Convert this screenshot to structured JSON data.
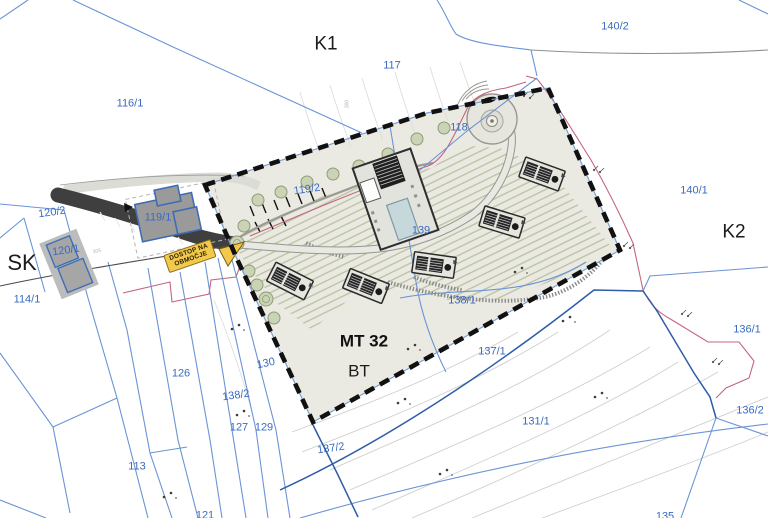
{
  "map": {
    "type": "cadastral-site-plan",
    "colors": {
      "parcel_label": "#3a6bc0",
      "zone_label": "#1c1c1c",
      "site_boundary_dash": "#111111",
      "parcel_line": "#6b94d6",
      "parcel_line_dark": "#2d5da8",
      "development_line_pink": "#c4657f",
      "site_fill": "#ebeae2",
      "road_dark": "#3f3f3f",
      "banner_bg": "#f2c94c",
      "tree_fill": "#cbd3b6",
      "pool_fill": "#c6d8da"
    }
  },
  "banner": {
    "line1": "DOSTOP NA",
    "line2": "OBMOČJE"
  },
  "labels": [
    {
      "text": "K1",
      "x": 326,
      "y": 44,
      "type": "zone",
      "size": 19,
      "rot": 0
    },
    {
      "text": "K2",
      "x": 734,
      "y": 232,
      "type": "zone",
      "size": 19,
      "rot": 0
    },
    {
      "text": "SK",
      "x": 22,
      "y": 263,
      "type": "zone",
      "size": 22,
      "rot": 0
    },
    {
      "text": "MT 32",
      "x": 364,
      "y": 341,
      "type": "zone-bold",
      "size": 17,
      "rot": 0
    },
    {
      "text": "BT",
      "x": 359,
      "y": 371,
      "type": "zone",
      "size": 17,
      "rot": 0
    },
    {
      "text": "116/1",
      "x": 130,
      "y": 104,
      "type": "parcel",
      "size": 11,
      "rot": 0
    },
    {
      "text": "117",
      "x": 392,
      "y": 66,
      "type": "parcel",
      "size": 11,
      "rot": 0
    },
    {
      "text": "140/2",
      "x": 615,
      "y": 27,
      "type": "parcel",
      "size": 11,
      "rot": 0
    },
    {
      "text": "140/1",
      "x": 694,
      "y": 191,
      "type": "parcel",
      "size": 11,
      "rot": 0
    },
    {
      "text": "136/1",
      "x": 747,
      "y": 330,
      "type": "parcel",
      "size": 11,
      "rot": 0
    },
    {
      "text": "136/2",
      "x": 750,
      "y": 411,
      "type": "parcel",
      "size": 11,
      "rot": 0
    },
    {
      "text": "120/2",
      "x": 52,
      "y": 213,
      "type": "parcel",
      "size": 11,
      "rot": -8
    },
    {
      "text": "120/1",
      "x": 66,
      "y": 251,
      "type": "parcel",
      "size": 11,
      "rot": -8
    },
    {
      "text": "119/1",
      "x": 158,
      "y": 218,
      "type": "parcel",
      "size": 11,
      "rot": 0
    },
    {
      "text": "119/2",
      "x": 307,
      "y": 190,
      "type": "parcel",
      "size": 11,
      "rot": -8
    },
    {
      "text": "114/1",
      "x": 27,
      "y": 300,
      "type": "parcel",
      "size": 11,
      "rot": 0
    },
    {
      "text": "118",
      "x": 459,
      "y": 128,
      "type": "parcel",
      "size": 11,
      "rot": 0
    },
    {
      "text": "139",
      "x": 421,
      "y": 231,
      "type": "parcel",
      "size": 11,
      "rot": 0
    },
    {
      "text": "138/1",
      "x": 462,
      "y": 301,
      "type": "parcel",
      "size": 11,
      "rot": 0
    },
    {
      "text": "137/1",
      "x": 492,
      "y": 352,
      "type": "parcel",
      "size": 11,
      "rot": 0
    },
    {
      "text": "131/1",
      "x": 536,
      "y": 422,
      "type": "parcel",
      "size": 11,
      "rot": 0
    },
    {
      "text": "137/2",
      "x": 331,
      "y": 449,
      "type": "parcel",
      "size": 11,
      "rot": -8
    },
    {
      "text": "130",
      "x": 266,
      "y": 364,
      "type": "parcel",
      "size": 11,
      "rot": -12
    },
    {
      "text": "138/2",
      "x": 236,
      "y": 396,
      "type": "parcel",
      "size": 11,
      "rot": -8
    },
    {
      "text": "126",
      "x": 181,
      "y": 374,
      "type": "parcel",
      "size": 11,
      "rot": 0
    },
    {
      "text": "127",
      "x": 239,
      "y": 428,
      "type": "parcel",
      "size": 11,
      "rot": 0
    },
    {
      "text": "129",
      "x": 264,
      "y": 428,
      "type": "parcel",
      "size": 11,
      "rot": 0
    },
    {
      "text": "113",
      "x": 137,
      "y": 467,
      "type": "parcel",
      "size": 11,
      "rot": 0
    },
    {
      "text": "121",
      "x": 205,
      "y": 516,
      "type": "parcel",
      "size": 11,
      "rot": 0
    },
    {
      "text": "135",
      "x": 665,
      "y": 517,
      "type": "parcel",
      "size": 11,
      "rot": 0
    },
    {
      "text": "300",
      "x": 348,
      "y": 104,
      "type": "contour",
      "size": 5,
      "rot": -90
    },
    {
      "text": "305",
      "x": 97,
      "y": 252,
      "type": "contour",
      "size": 5,
      "rot": -10
    }
  ]
}
